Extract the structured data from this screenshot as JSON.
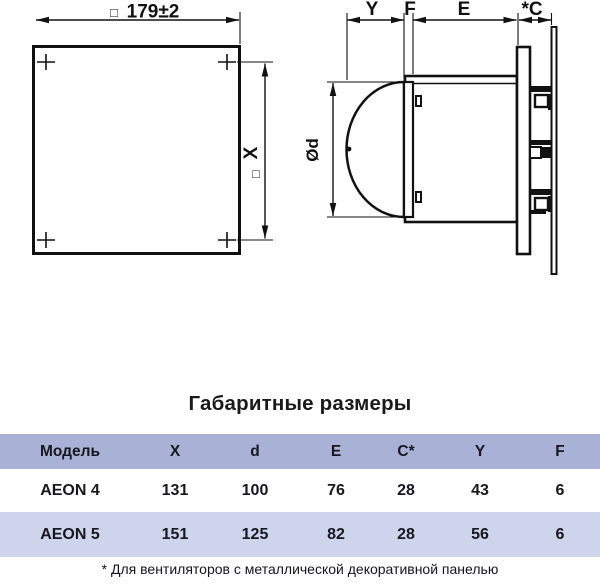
{
  "front_view": {
    "square_symbol": "□",
    "width_dimension": "179±2",
    "height_dimension": "X"
  },
  "side_view": {
    "dim_y": "Y",
    "dim_f": "F",
    "dim_e": "E",
    "dim_c": "*C",
    "diameter": "Ød"
  },
  "table": {
    "title": "Габаритные размеры",
    "columns": [
      "Модель",
      "X",
      "d",
      "E",
      "C*",
      "Y",
      "F"
    ],
    "rows": [
      {
        "cells": [
          "AEON 4",
          "131",
          "100",
          "76",
          "28",
          "43",
          "6"
        ]
      },
      {
        "cells": [
          "AEON 5",
          "151",
          "125",
          "82",
          "28",
          "56",
          "6"
        ]
      }
    ],
    "footnote": "* Для вентиляторов с металлической декоративной панелью",
    "colors": {
      "header_bg": "#a9b2d6",
      "row_alt_bg": "#ced4eb",
      "text": "#17171f"
    }
  }
}
